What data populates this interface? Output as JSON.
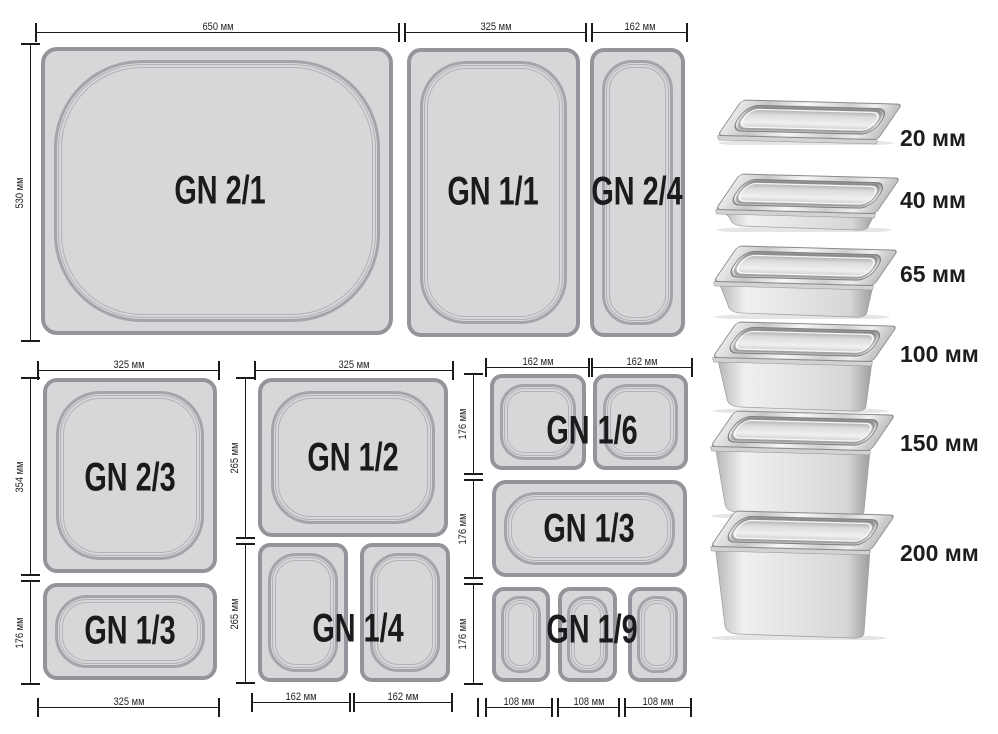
{
  "schematic": {
    "top_row": {
      "width_dims": [
        "650 мм",
        "325 мм",
        "162 мм"
      ],
      "height_dim": "530 мм",
      "pans": [
        "GN 2/1",
        "GN 1/1",
        "GN 2/4"
      ]
    },
    "bottom_left": {
      "top_dim": "325 мм",
      "height_dims": [
        "354 мм",
        "176 мм"
      ],
      "bottom_dim": "325 мм",
      "pans": [
        "GN 2/3",
        "GN 1/3"
      ]
    },
    "bottom_middle": {
      "top_dim": "325 мм",
      "height_dims": [
        "265 мм",
        "265 мм"
      ],
      "bottom_dims": [
        "162 мм",
        "162 мм"
      ],
      "pans": [
        "GN 1/2",
        "GN 1/4"
      ]
    },
    "bottom_right": {
      "top_dims": [
        "162 мм",
        "162 мм"
      ],
      "height_dims": [
        "176 мм",
        "176 мм",
        "176 мм"
      ],
      "bottom_dims": [
        "108 мм",
        "108 мм",
        "108 мм"
      ],
      "pans": [
        "GN 1/6",
        "GN 1/3",
        "GN 1/9"
      ]
    }
  },
  "depth_list": {
    "items": [
      "20 мм",
      "40 мм",
      "65 мм",
      "100 мм",
      "150 мм",
      "200 мм"
    ]
  },
  "colors": {
    "pan_fill": "#d7d7d9",
    "pan_border": "#94949a",
    "rim_line": "#a4a4a9",
    "dim_line": "#1a1a1a",
    "label_text": "#1b1b1d"
  }
}
